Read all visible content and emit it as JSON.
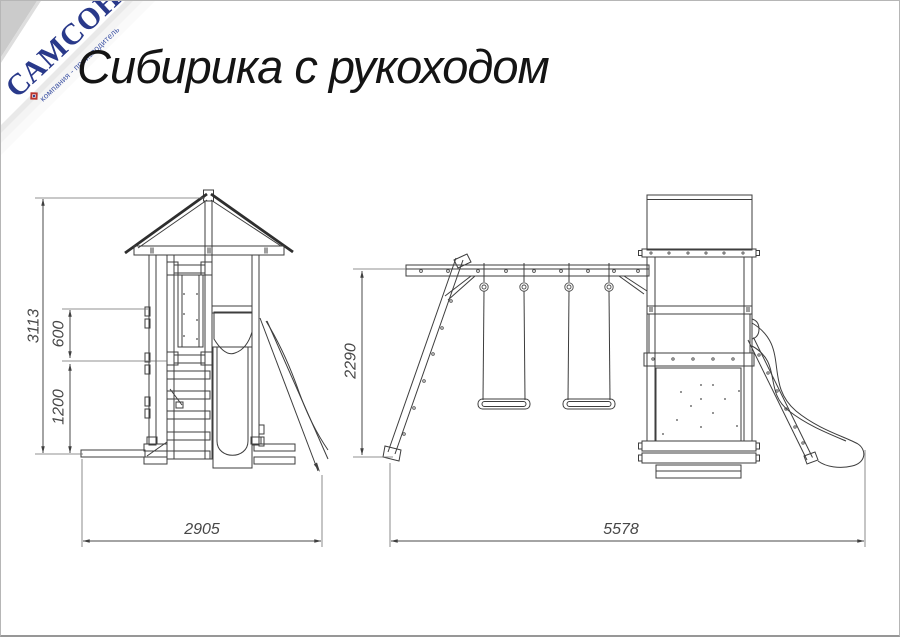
{
  "page": {
    "title": "Сибирика с рукоходом"
  },
  "logo": {
    "name": "САМСОН",
    "tagline": "компания - производитель"
  },
  "drawing": {
    "front_view": {
      "dim_total_height": "3113",
      "dim_rail_height": "600",
      "dim_deck_height": "1200",
      "dim_width": "2905"
    },
    "side_view": {
      "dim_beam_height": "2290",
      "dim_length": "5578"
    }
  }
}
